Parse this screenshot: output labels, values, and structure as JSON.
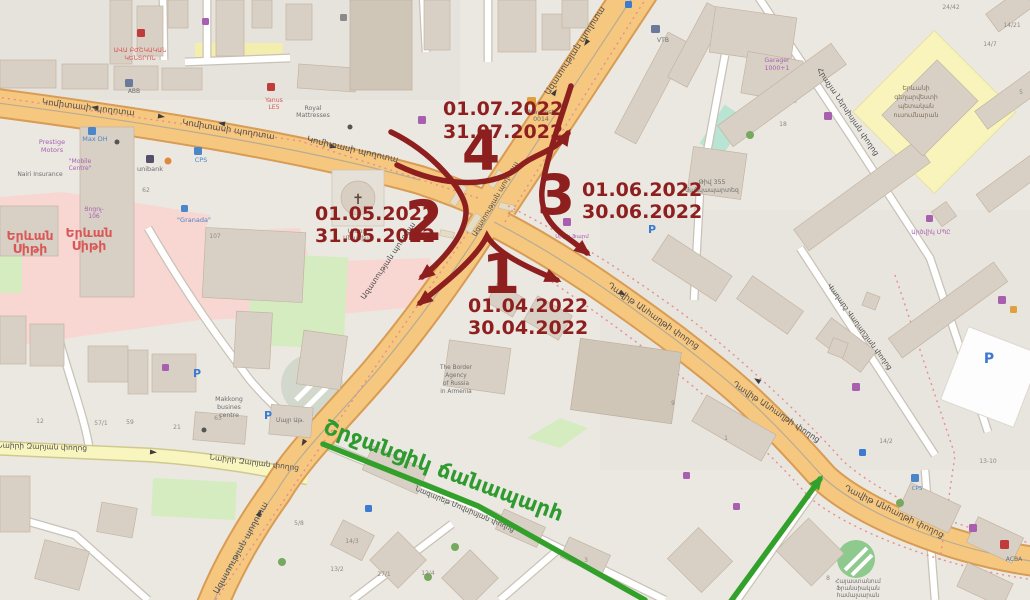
{
  "annotation": {
    "stages": [
      {
        "number": "1",
        "date_from": "01.04.2022",
        "date_to": "30.04.2022"
      },
      {
        "number": "2",
        "date_from": "01.05.2022",
        "date_to": "31.05.2022"
      },
      {
        "number": "3",
        "date_from": "01.06.2022",
        "date_to": "30.06.2022"
      },
      {
        "number": "4",
        "date_from": "01.07.2022",
        "date_to": "31.07.2022"
      }
    ],
    "bypass_label": "Շրջանցիկ ճանապարհ"
  },
  "streets": {
    "komitas": "Կոմիտասի պողոտա",
    "azatutyan": "Ազատության պողոտա",
    "davit_anhaght": "Դավիթ Անհաղթի փողոց",
    "nairi_zaryan": "Նաիրի Զարյան փողոց",
    "nersisyan": "Հրաչյա Ներսիսյան փողոց",
    "vagharshyan": "Վաղարշ Վաղարշյան փողոց",
    "movsisyan": "Նազարեթ Մովսիսյան փողոց"
  },
  "places": {
    "yerevan_city": [
      "Երևան",
      "Սիթի"
    ],
    "ava_dental": [
      "ԱՎԱ ԲԺՇԿԱԿԱՆ",
      "ԿԵՆՏՐՈՆ"
    ],
    "prestige": [
      "Prestige",
      "Motors"
    ],
    "mobile_centre": [
      "\"Mobile",
      "Centre\""
    ],
    "nairi_insurance": "Nairi Insurance",
    "max_dh": "Max DH",
    "unibank": "unibank",
    "cps": "CPS",
    "granada": "\"Granada\"",
    "cocol": [
      "Ցոցոլ-",
      "106"
    ],
    "abb": "ABB",
    "vtb": "VTB",
    "yanus": [
      "Yanus",
      "LE5"
    ],
    "royal": [
      "Royal",
      "Mattresses"
    ],
    "maypost": [
      "MayPost",
      "0014"
    ],
    "garager": [
      "Garager",
      "1000+1"
    ],
    "kindergarten": [
      "Թիվ 355",
      "մանկապարտեզ"
    ],
    "art_school": [
      "Երևանի",
      "գեղարվեստի",
      "պետական",
      "ուսումնարան"
    ],
    "makkong": [
      "Makkong",
      "busines",
      "centre"
    ],
    "mayr_at": "Մայր Աթ.",
    "border_agency": [
      "The Border",
      "Agency",
      "of Russia",
      "in Armenia"
    ],
    "french_university": [
      "Հայաստանում",
      "Ֆրանսիական",
      "համալսարան"
    ],
    "acba": "ACBA",
    "artsvik": "Արծվիկ ՄՊԸ",
    "city_pharm": "Սիթի Ֆարմ",
    "church": [
      "Սուրբ",
      "Անանիա"
    ],
    "parking_letter": "P"
  },
  "house_numbers": [
    "18",
    "9",
    "14/2",
    "13-10",
    "57/1",
    "59",
    "12",
    "63",
    "21",
    "27/1",
    "12/4",
    "14/3",
    "5/8",
    "13/2",
    "24/42",
    "14/21",
    "14/7",
    "62",
    "107",
    "8",
    "3",
    "1",
    "5"
  ],
  "icons": [
    {
      "name": "parking-icon",
      "color": "#3d7ad1"
    },
    {
      "name": "bus-stop-icon",
      "color": "#3d7ad1"
    },
    {
      "name": "pharmacy-icon",
      "color": "#a95fb0"
    },
    {
      "name": "restaurant-icon",
      "color": "#a95fb0"
    },
    {
      "name": "shop-icon",
      "color": "#a95fb0"
    },
    {
      "name": "fuel-icon",
      "color": "#4a86c8"
    },
    {
      "name": "mail-icon",
      "color": "#e0a13c"
    },
    {
      "name": "dental-icon",
      "color": "#c23b3b"
    },
    {
      "name": "hospital-cross-icon",
      "color": "#c23b3b"
    },
    {
      "name": "church-cross-icon",
      "color": "#5a4a3a"
    },
    {
      "name": "tree-icon",
      "color": "#76a860"
    }
  ],
  "colors": {
    "land": "#ebe8e2",
    "building": "#d9d0c5",
    "building_outline": "#c3b4a3",
    "road_major": "#f6c77f",
    "road_major_casing": "#d89c54",
    "road_minor": "#ffffff",
    "road_minor_casing": "#c9c2b6",
    "road_tertiary": "#f9f5be",
    "road_tertiary_casing": "#cfc98f",
    "pink_area": "#f8d6d2",
    "park": "#d5ecc1",
    "school_area": "#f8f4bb",
    "mint_area": "#b9e3d3",
    "boundary_dash": "#e68f8f",
    "annotation_red": "#8e1f1f",
    "bypass_green": "#2f9a30",
    "label_red": "#d95757",
    "label_purple": "#a95fb0",
    "label_blue": "#4a86c8",
    "label_gray": "#6e6e6e"
  }
}
